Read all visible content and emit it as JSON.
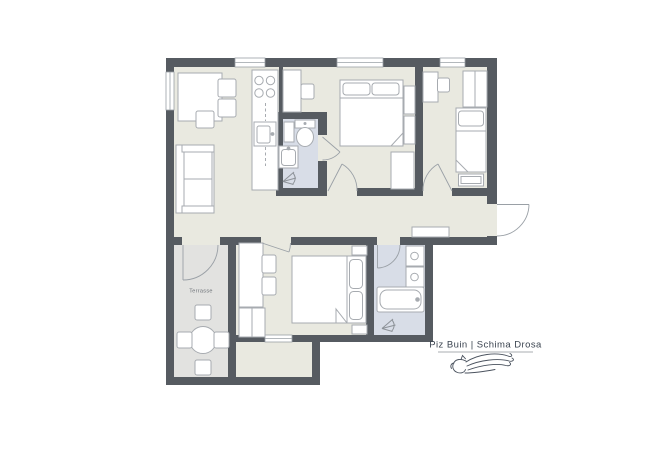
{
  "branding": {
    "title": "Piz Buin | Schima Drosa",
    "logo_icon": "horse-head-with-flowing-mane-icon"
  },
  "labels": {
    "terrace": "Terrasse"
  },
  "colors": {
    "wall": "#565b61",
    "floor_interior": "#e9e9e0",
    "floor_terrace": "#e2e2e0",
    "floor_wet_room": "#d8dde7",
    "furniture_fill": "#ffffff",
    "furniture_stroke": "#a7abb0",
    "door_line": "#9aa0a6",
    "brand_text": "#3b4450"
  },
  "plan": {
    "type": "apartment-floor-plan",
    "rooms": [
      "living-room-with-kitchen",
      "wc-ensuite",
      "bedroom-double-top",
      "bedroom-single-right",
      "hallway",
      "bedroom-double-bottom",
      "bathroom",
      "terrace",
      "storage-extension"
    ],
    "fixtures": [
      "stove-4-burners",
      "kitchen-sink",
      "toilet",
      "washbasin",
      "shower-icon",
      "bathtub",
      "double-bed-x2",
      "single-bed",
      "wardrobes",
      "desks-with-chairs",
      "sofa",
      "dining-table",
      "round-terrace-table-with-4-chairs",
      "sideboard"
    ]
  }
}
